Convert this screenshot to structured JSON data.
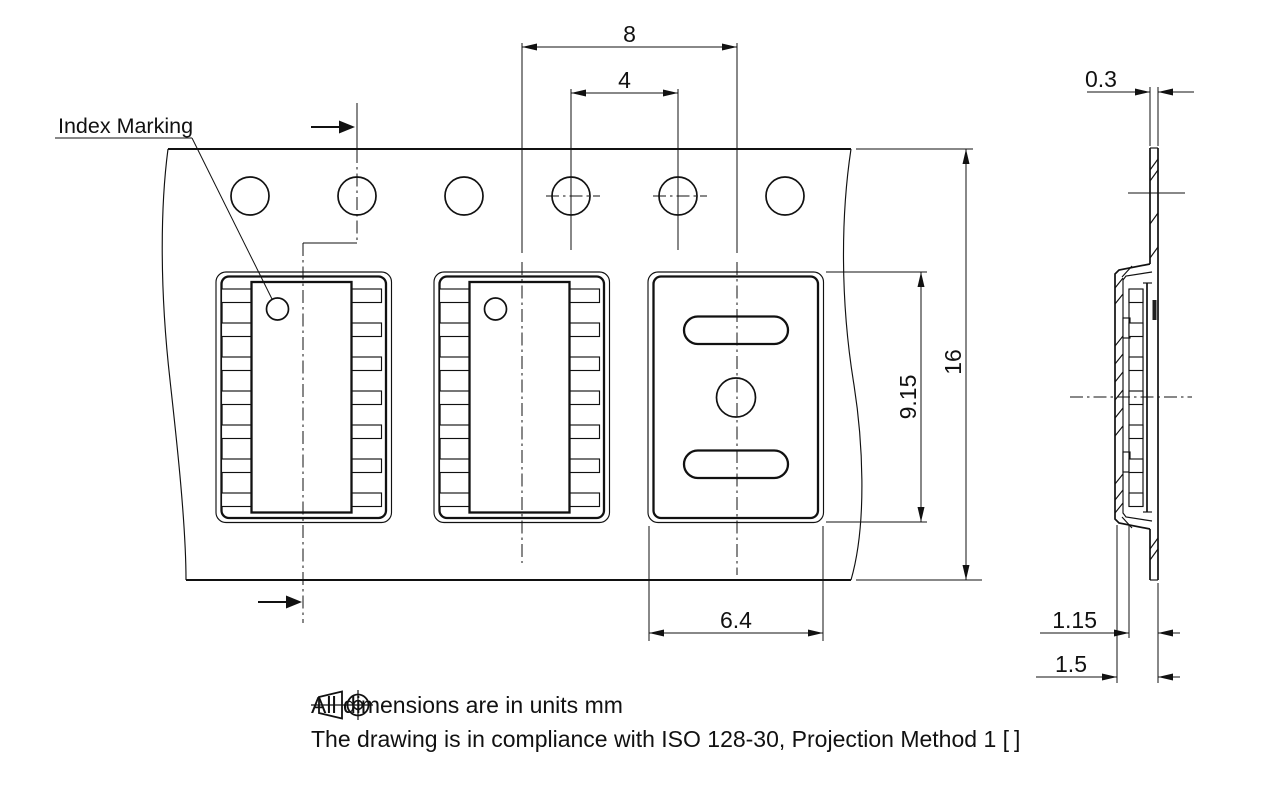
{
  "drawing": {
    "labels": {
      "index_marking": "Index Marking"
    },
    "dims": {
      "pocket_pitch": "8",
      "hole_pitch": "4",
      "tape_width": "16",
      "pocket_length": "9.15",
      "pocket_width": "6.4",
      "tape_thickness": "0.3",
      "depth_inner": "1.15",
      "depth_total": "1.5"
    },
    "notes": {
      "line1": "All dimensions are in units mm",
      "line2_prefix": "The drawing is in compliance with ISO 128-30, Projection Method 1 [",
      "line2_suffix": "]"
    },
    "colors": {
      "ink": "#111111",
      "background": "#ffffff"
    }
  }
}
